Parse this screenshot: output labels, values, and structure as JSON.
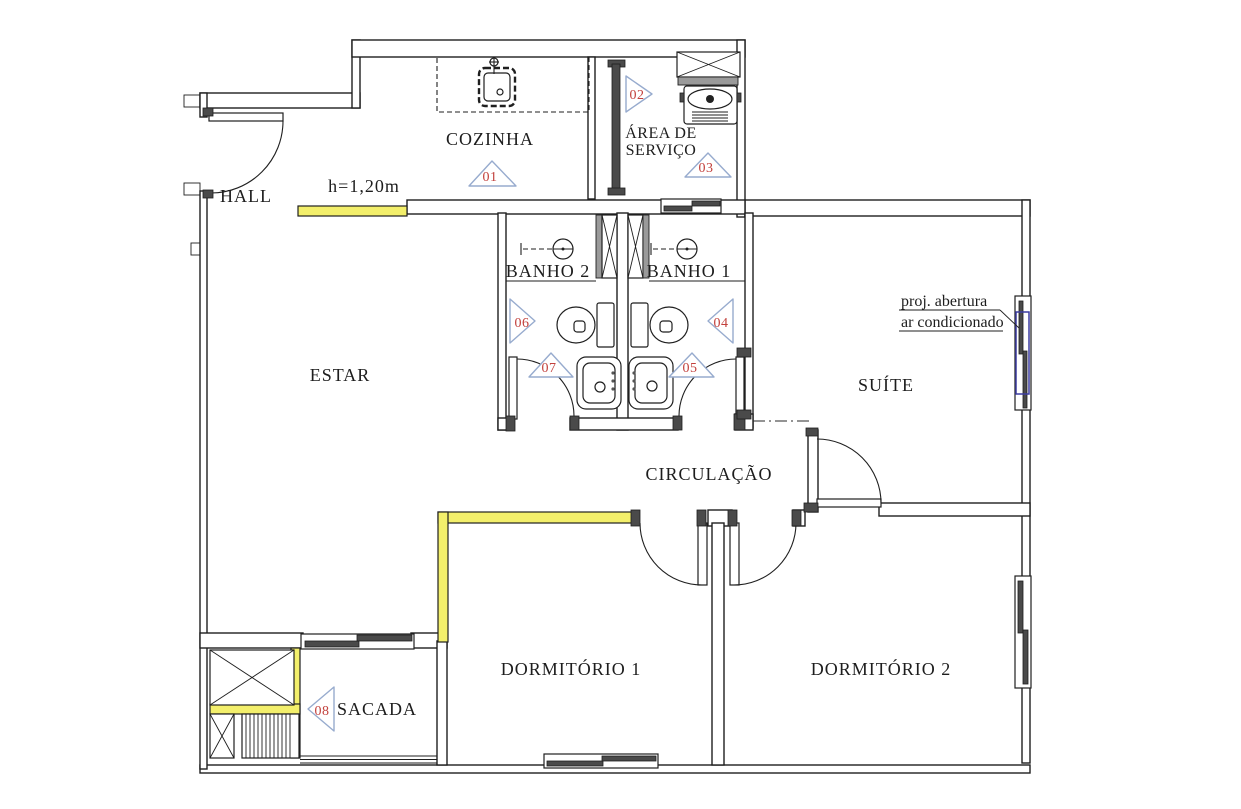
{
  "plan_type": "apartment floor plan",
  "rooms": {
    "hall": "HALL",
    "cozinha": "COZINHA",
    "area_servico_line1": "ÁREA DE",
    "area_servico_line2": "SERVIÇO",
    "banho2": "BANHO 2",
    "banho1": "BANHO 1",
    "estar": "ESTAR",
    "suite": "SUÍTE",
    "circulacao": "CIRCULAÇÃO",
    "dormitorio1": "DORMITÓRIO 1",
    "dormitorio2": "DORMITÓRIO 2",
    "sacada": "SACADA"
  },
  "annotations": {
    "half_wall_height": "h=1,20m",
    "ac_note_line1": "proj. abertura",
    "ac_note_line2": "ar condicionado"
  },
  "markers": [
    {
      "number": "01",
      "direction": "up"
    },
    {
      "number": "02",
      "direction": "right"
    },
    {
      "number": "03",
      "direction": "up"
    },
    {
      "number": "04",
      "direction": "left"
    },
    {
      "number": "05",
      "direction": "up"
    },
    {
      "number": "06",
      "direction": "right"
    },
    {
      "number": "07",
      "direction": "up"
    },
    {
      "number": "08",
      "direction": "left"
    }
  ],
  "colors": {
    "highlight_wall_yellow": "#f3ef6b",
    "marker_number_red": "#c2403c",
    "marker_outline_blue": "#97abce",
    "ac_projection_blue": "#3c3ca0",
    "linework": "#1f1f1f",
    "background": "#ffffff"
  }
}
